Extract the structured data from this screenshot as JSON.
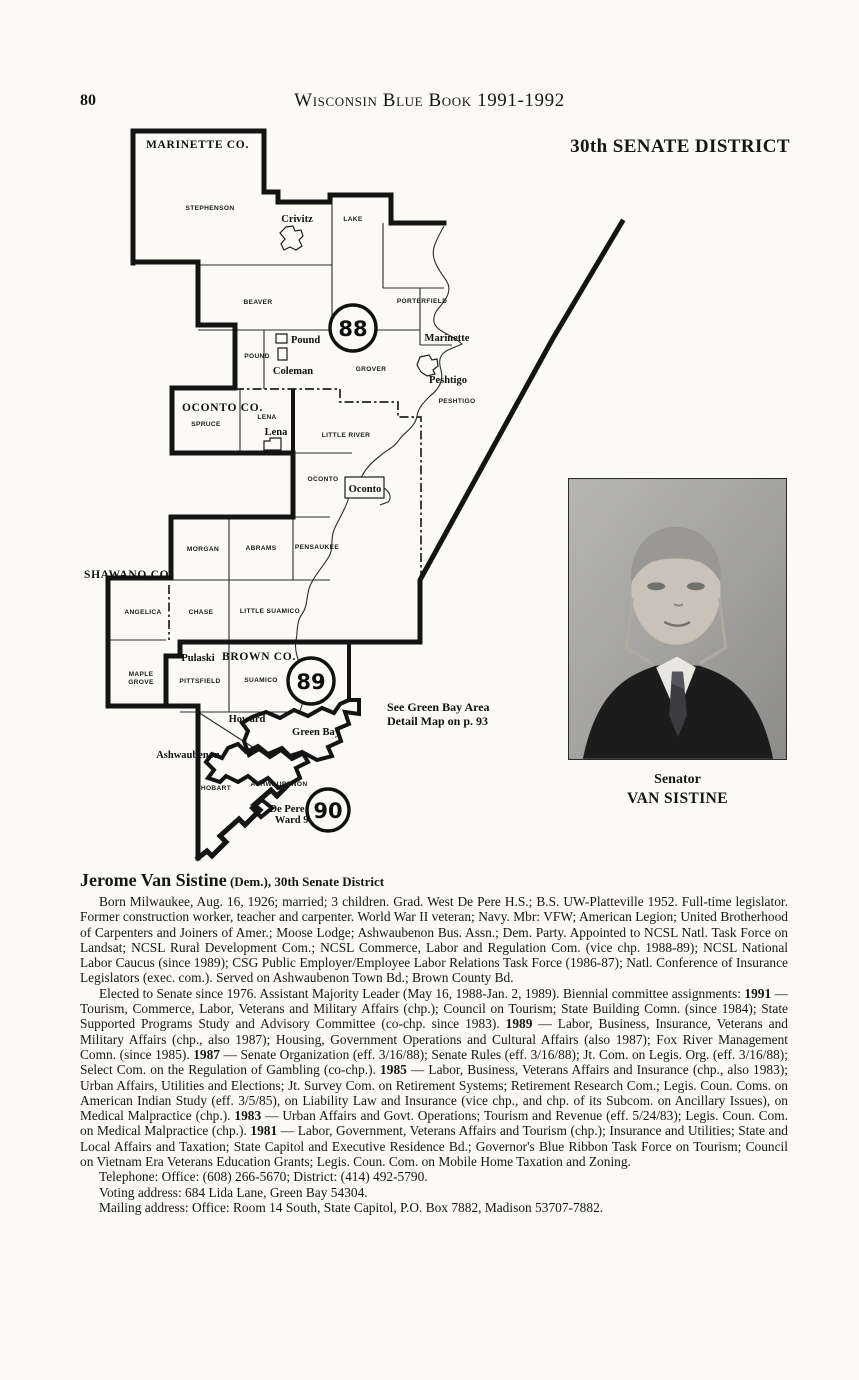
{
  "header": {
    "page_number": "80",
    "book_title": "Wisconsin Blue Book 1991-1992",
    "district_title": "30th SENATE DISTRICT"
  },
  "map": {
    "counties": [
      {
        "label": "MARINETTE CO."
      },
      {
        "label": "OCONTO CO."
      },
      {
        "label": "SHAWANO CO."
      },
      {
        "label": "BROWN CO."
      }
    ],
    "towns": [
      {
        "label": "STEPHENSON"
      },
      {
        "label": "LAKE"
      },
      {
        "label": "BEAVER"
      },
      {
        "label": "PORTERFIELD"
      },
      {
        "label": "POUND"
      },
      {
        "label": "GROVER"
      },
      {
        "label": "PESHTIGO"
      },
      {
        "label": "LENA"
      },
      {
        "label": "SPRUCE"
      },
      {
        "label": "LITTLE RIVER"
      },
      {
        "label": "OCONTO"
      },
      {
        "label": "MORGAN"
      },
      {
        "label": "ABRAMS"
      },
      {
        "label": "PENSAUKEE"
      },
      {
        "label": "ANGELICA"
      },
      {
        "label": "CHASE"
      },
      {
        "label": "LITTLE SUAMICO"
      },
      {
        "label": "MAPLE"
      },
      {
        "label": "GROVE"
      },
      {
        "label": "PITTSFIELD"
      },
      {
        "label": "SUAMICO"
      },
      {
        "label": "HOBART"
      },
      {
        "label": "ASHWAUBENON"
      }
    ],
    "places": [
      {
        "label": "Crivitz"
      },
      {
        "label": "Pound"
      },
      {
        "label": "Coleman"
      },
      {
        "label": "Marinette"
      },
      {
        "label": "Peshtigo"
      },
      {
        "label": "Lena"
      },
      {
        "label": "Oconto"
      },
      {
        "label": "Pulaski"
      },
      {
        "label": "Howard"
      },
      {
        "label": "Green Bay"
      },
      {
        "label": "Ashwaubenon"
      },
      {
        "label": "De Pere"
      },
      {
        "label": "Ward 9."
      }
    ],
    "districts": [
      {
        "number": "88"
      },
      {
        "number": "89"
      },
      {
        "number": "90"
      }
    ],
    "note": {
      "line1": "See Green Bay Area",
      "line2": "Detail Map on p. 93"
    }
  },
  "photo": {
    "caption_line1": "Senator",
    "caption_line2": "VAN SISTINE"
  },
  "bio": {
    "heading_name": "Jerome Van Sistine",
    "heading_suffix": " (Dem.), 30th Senate District",
    "paragraph1": "Born Milwaukee, Aug. 16, 1926; married; 3 children. Grad. West De Pere H.S.; B.S. UW-Platteville 1952. Full-time legislator. Former construction worker, teacher and carpenter. World War II veteran; Navy. Mbr: VFW; American Legion; United Brotherhood of Carpenters and Joiners of Amer.; Moose Lodge; Ashwaubenon Bus. Assn.; Dem. Party. Appointed to NCSL Natl. Task Force on Landsat; NCSL Rural Development Com.; NCSL Commerce, Labor and Regulation Com. (vice chp. 1988-89); NCSL National Labor Caucus (since 1989); CSG Public Employer/Employee Labor Relations Task Force (1986-87); Natl. Conference of Insurance Legislators (exec. com.). Served on Ashwaubenon Town Bd.; Brown County Bd.",
    "paragraph2_segments": [
      {
        "t": "Elected to Senate since 1976. Assistant Majority Leader (May 16, 1988-Jan. 2, 1989). Biennial committee assignments: "
      },
      {
        "t": "1991",
        "b": true
      },
      {
        "t": " — Tourism, Commerce, Labor, Veterans and Military Affairs (chp.); Council on Tourism; State Building Comn. (since 1984); State Supported Programs Study and Advisory Committee (co-chp. since 1983). "
      },
      {
        "t": "1989",
        "b": true
      },
      {
        "t": " — Labor, Business, Insurance, Veterans and Military Affairs (chp., also 1987); Housing, Government Operations and Cultural Affairs (also 1987); Fox River Management Comn. (since 1985). "
      },
      {
        "t": "1987",
        "b": true
      },
      {
        "t": " — Senate Organization (eff. 3/16/88); Senate Rules (eff. 3/16/88); Jt. Com. on Legis. Org. (eff. 3/16/88); Select Com. on the Regulation of Gambling (co-chp.). "
      },
      {
        "t": "1985",
        "b": true
      },
      {
        "t": " — Labor, Business, Veterans Affairs and Insurance (chp., also 1983); Urban Affairs, Utilities and Elections; Jt. Survey Com. on Retirement Systems; Retirement Research Com.; Legis. Coun. Coms. on American Indian Study (eff. 3/5/85), on Liability Law and Insurance (vice chp., and chp. of its Subcom. on Ancillary Issues), on Medical Malpractice (chp.). "
      },
      {
        "t": "1983",
        "b": true
      },
      {
        "t": " — Urban Affairs and Govt. Operations; Tourism and Revenue (eff. 5/24/83); Legis. Coun. Com. on Medical Malpractice (chp.). "
      },
      {
        "t": "1981",
        "b": true
      },
      {
        "t": " — Labor, Government, Veterans Affairs and Tourism (chp.); Insurance and Utilities; State and Local Affairs and Taxation; State Capitol and Executive Residence Bd.; Governor's Blue Ribbon Task Force on Tourism; Council on Vietnam Era Veterans Education Grants; Legis. Coun. Com. on Mobile Home Taxation and Zoning."
      }
    ],
    "telephone": "Telephone: Office: (608) 266-5670; District: (414) 492-5790.",
    "voting_address": "Voting address: 684 Lida Lane, Green Bay 54304.",
    "mailing_address": "Mailing address: Office: Room 14 South, State Capitol, P.O. Box 7882, Madison 53707-7882."
  }
}
